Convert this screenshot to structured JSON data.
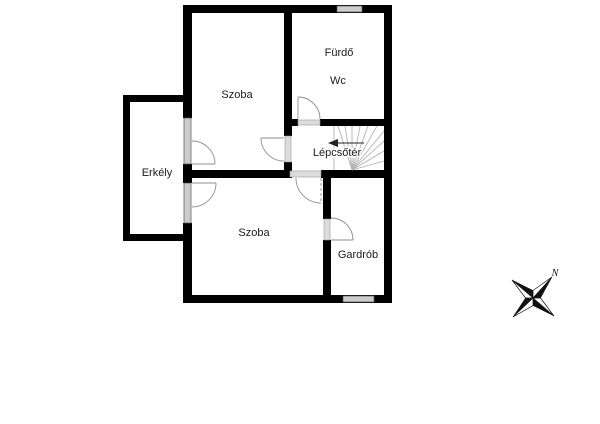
{
  "plan": {
    "type": "floorplan",
    "rooms": [
      {
        "id": "szoba-upper",
        "name": "Szoba"
      },
      {
        "id": "furdo",
        "name": "Fürdő"
      },
      {
        "id": "wc",
        "name": "Wc"
      },
      {
        "id": "erkely",
        "name": "Erkély"
      },
      {
        "id": "lepcsoter",
        "name": "Lépcsőtér"
      },
      {
        "id": "szoba-lower",
        "name": "Szoba"
      },
      {
        "id": "gardrob",
        "name": "Gardrób"
      }
    ],
    "features": [
      "stairs-winder",
      "balcony",
      "4 windows",
      "6 door-swings",
      "stair-direction-arrow"
    ],
    "compass": {
      "north_label": "N"
    },
    "colors": {
      "background": "#ffffff",
      "wall": "#000000",
      "window_glass": "#cccccc",
      "opening": "#dcdcdc",
      "stair_line": "#b3b3b3",
      "door_arc": "#8f8f8f",
      "text": "#1a1a1a"
    }
  }
}
